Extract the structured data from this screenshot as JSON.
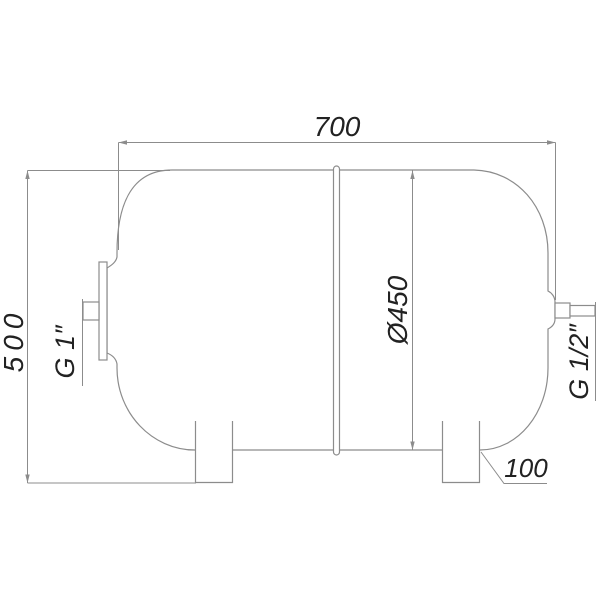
{
  "drawing": {
    "background": "#ffffff",
    "line_color": "#8c8c8c",
    "text_color": "#222222",
    "labels": {
      "length": "700",
      "height": "500",
      "diameter": "Ø450",
      "leg_offset": "100",
      "left_port_thread": "G 1″",
      "right_port_thread": "G 1/2″"
    }
  }
}
